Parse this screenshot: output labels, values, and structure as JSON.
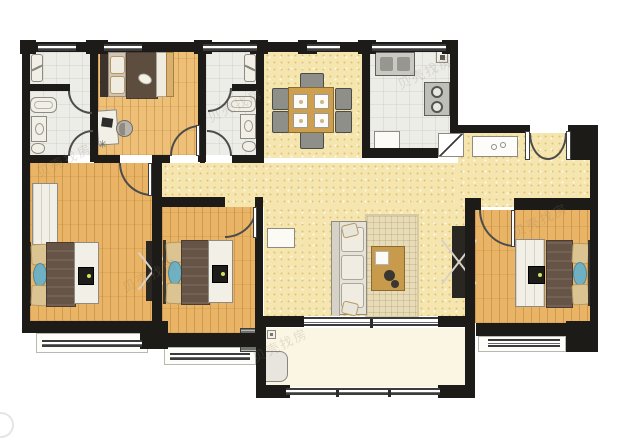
{
  "meta": {
    "type": "residential-floor-plan",
    "watermark": "贝壳找房",
    "rooms_count": 12
  },
  "palette": {
    "wall": "#1d1b18",
    "wood_floor": "#e9b465",
    "open_area_floor": "#f5e5ae",
    "tile_floor": "#ededE8",
    "balcony_floor": "#fbf6e3",
    "rug": "#e8dcb8",
    "blanket_brown": "#665446",
    "pillow_tan": "#dcc392",
    "accent_blue": "#6fb0c3",
    "table_wood": "#cf9f50",
    "dark_furniture": "#2a2723",
    "tv_power_dot": "#d4e15c"
  },
  "rooms": [
    {
      "id": "bathroom-1",
      "area": "top-left",
      "floor": "tile",
      "furniture": [
        "shower-fixture",
        "bathtub",
        "vanity-sink",
        "toilet",
        "divider-door",
        "entry-door"
      ]
    },
    {
      "id": "bedroom-small",
      "area": "top",
      "floor": "wood",
      "furniture": [
        "double-bed",
        "desk",
        "desk-chair",
        "plant",
        "door"
      ]
    },
    {
      "id": "bathroom-2",
      "area": "top-middle",
      "floor": "tile",
      "furniture": [
        "shower-fixture",
        "bathtub",
        "vanity-sink",
        "toilet",
        "divider-door",
        "entry-door"
      ]
    },
    {
      "id": "dining-area",
      "area": "top-center",
      "floor": "open",
      "furniture": [
        "dining-table",
        "chairs-x6",
        "place-settings-x4"
      ]
    },
    {
      "id": "kitchen",
      "area": "top-right",
      "floor": "tile",
      "furniture": [
        "double-sink",
        "gas-meter",
        "cooktop-2-burners",
        "refrigerator",
        "corner-door"
      ]
    },
    {
      "id": "entry-foyer",
      "area": "right",
      "floor": "open",
      "furniture": [
        "double-entry-door",
        "shoe-cabinet"
      ]
    },
    {
      "id": "hallway",
      "area": "center",
      "floor": "open",
      "furniture": []
    },
    {
      "id": "living-room",
      "area": "center",
      "floor": "open",
      "furniture": [
        "sofa",
        "rug",
        "coffee-table",
        "tv-cabinet",
        "side-cabinet"
      ]
    },
    {
      "id": "bedroom-left",
      "area": "bottom-left",
      "floor": "wood",
      "furniture": [
        "closet",
        "double-bed",
        "tv-stand",
        "wardrobe",
        "bay-window"
      ]
    },
    {
      "id": "bedroom-middle",
      "area": "bottom-center",
      "floor": "wood",
      "furniture": [
        "double-bed",
        "tv-stand",
        "bay-window"
      ]
    },
    {
      "id": "master-bedroom",
      "area": "bottom-right",
      "floor": "wood",
      "furniture": [
        "wardrobe",
        "tv",
        "double-bed",
        "bay-window",
        "door"
      ]
    },
    {
      "id": "balcony",
      "area": "bottom",
      "floor": "balcony",
      "furniture": [
        "floor-drain",
        "washing-machine",
        "railing",
        "sliding-window"
      ]
    }
  ],
  "exterior_items": [
    "ac-outdoor-unit"
  ]
}
